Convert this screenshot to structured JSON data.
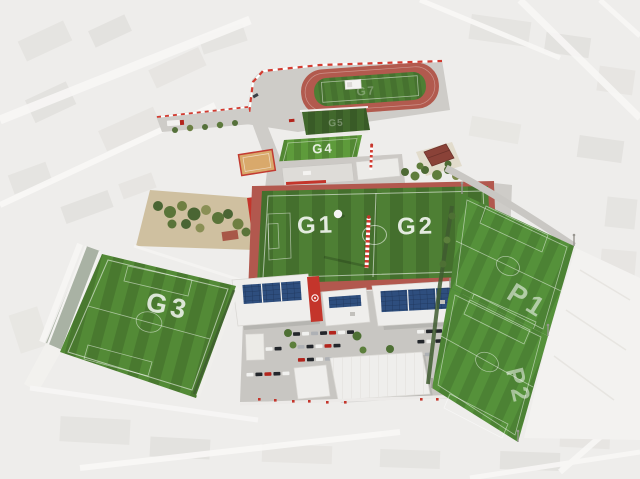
{
  "facility": {
    "pitch_labels": {
      "g1": "G1",
      "g2": "G2",
      "g3": "G3",
      "g4": "G4",
      "g5": "G5",
      "g7": "G7",
      "p1": "P1",
      "p2": "P2"
    }
  },
  "colors": {
    "city_base": "#eeedeb",
    "city_block": "#e1dfdb",
    "street": "#f8f7f6",
    "asphalt": "#c8c6c2",
    "pavement": "#ceccc8",
    "turf_main": "#4e7f34",
    "turf_bright": "#5e9b3b",
    "turf_dark": "#41682c",
    "turf_g3": "#538a36",
    "turf_p": "#55913a",
    "track_surface": "#b25a4e",
    "apron_red": "#b2584e",
    "accent_red": "#c4352b",
    "sand": "#d9a96b",
    "canal_water": "#a9b2a4",
    "solar_blue": "#2e4e7e",
    "roof_white": "#efeeec",
    "tree_green": "#4e6a34",
    "label_white": "#ffffff"
  }
}
